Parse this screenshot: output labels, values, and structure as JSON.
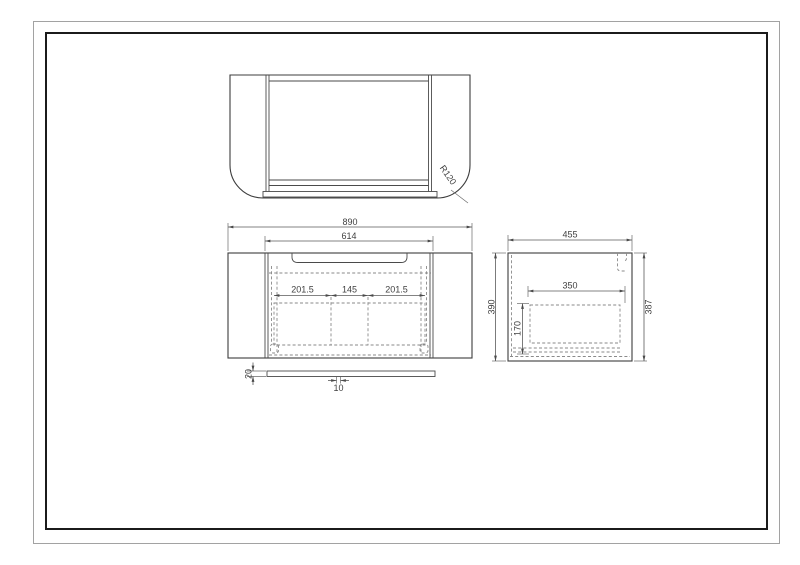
{
  "sheet": {
    "background": "#ffffff",
    "outer_border_color": "#a2a2a2",
    "inner_border_color": "#1b1b1b",
    "line_color": "#3c3c3c",
    "dashed_line_color": "#8a8a8a"
  },
  "views": {
    "top": {
      "corner_radius": "R120"
    },
    "front": {
      "overall_width": "890",
      "opening_width": "614",
      "compartment_widths": [
        "201.5",
        "145",
        "201.5"
      ],
      "shelf_thickness": "20",
      "shelf_offset": "10"
    },
    "side": {
      "overall_depth": "455",
      "height_left": "390",
      "height_right": "387",
      "drawer_depth": "350",
      "drawer_height": "170"
    }
  }
}
